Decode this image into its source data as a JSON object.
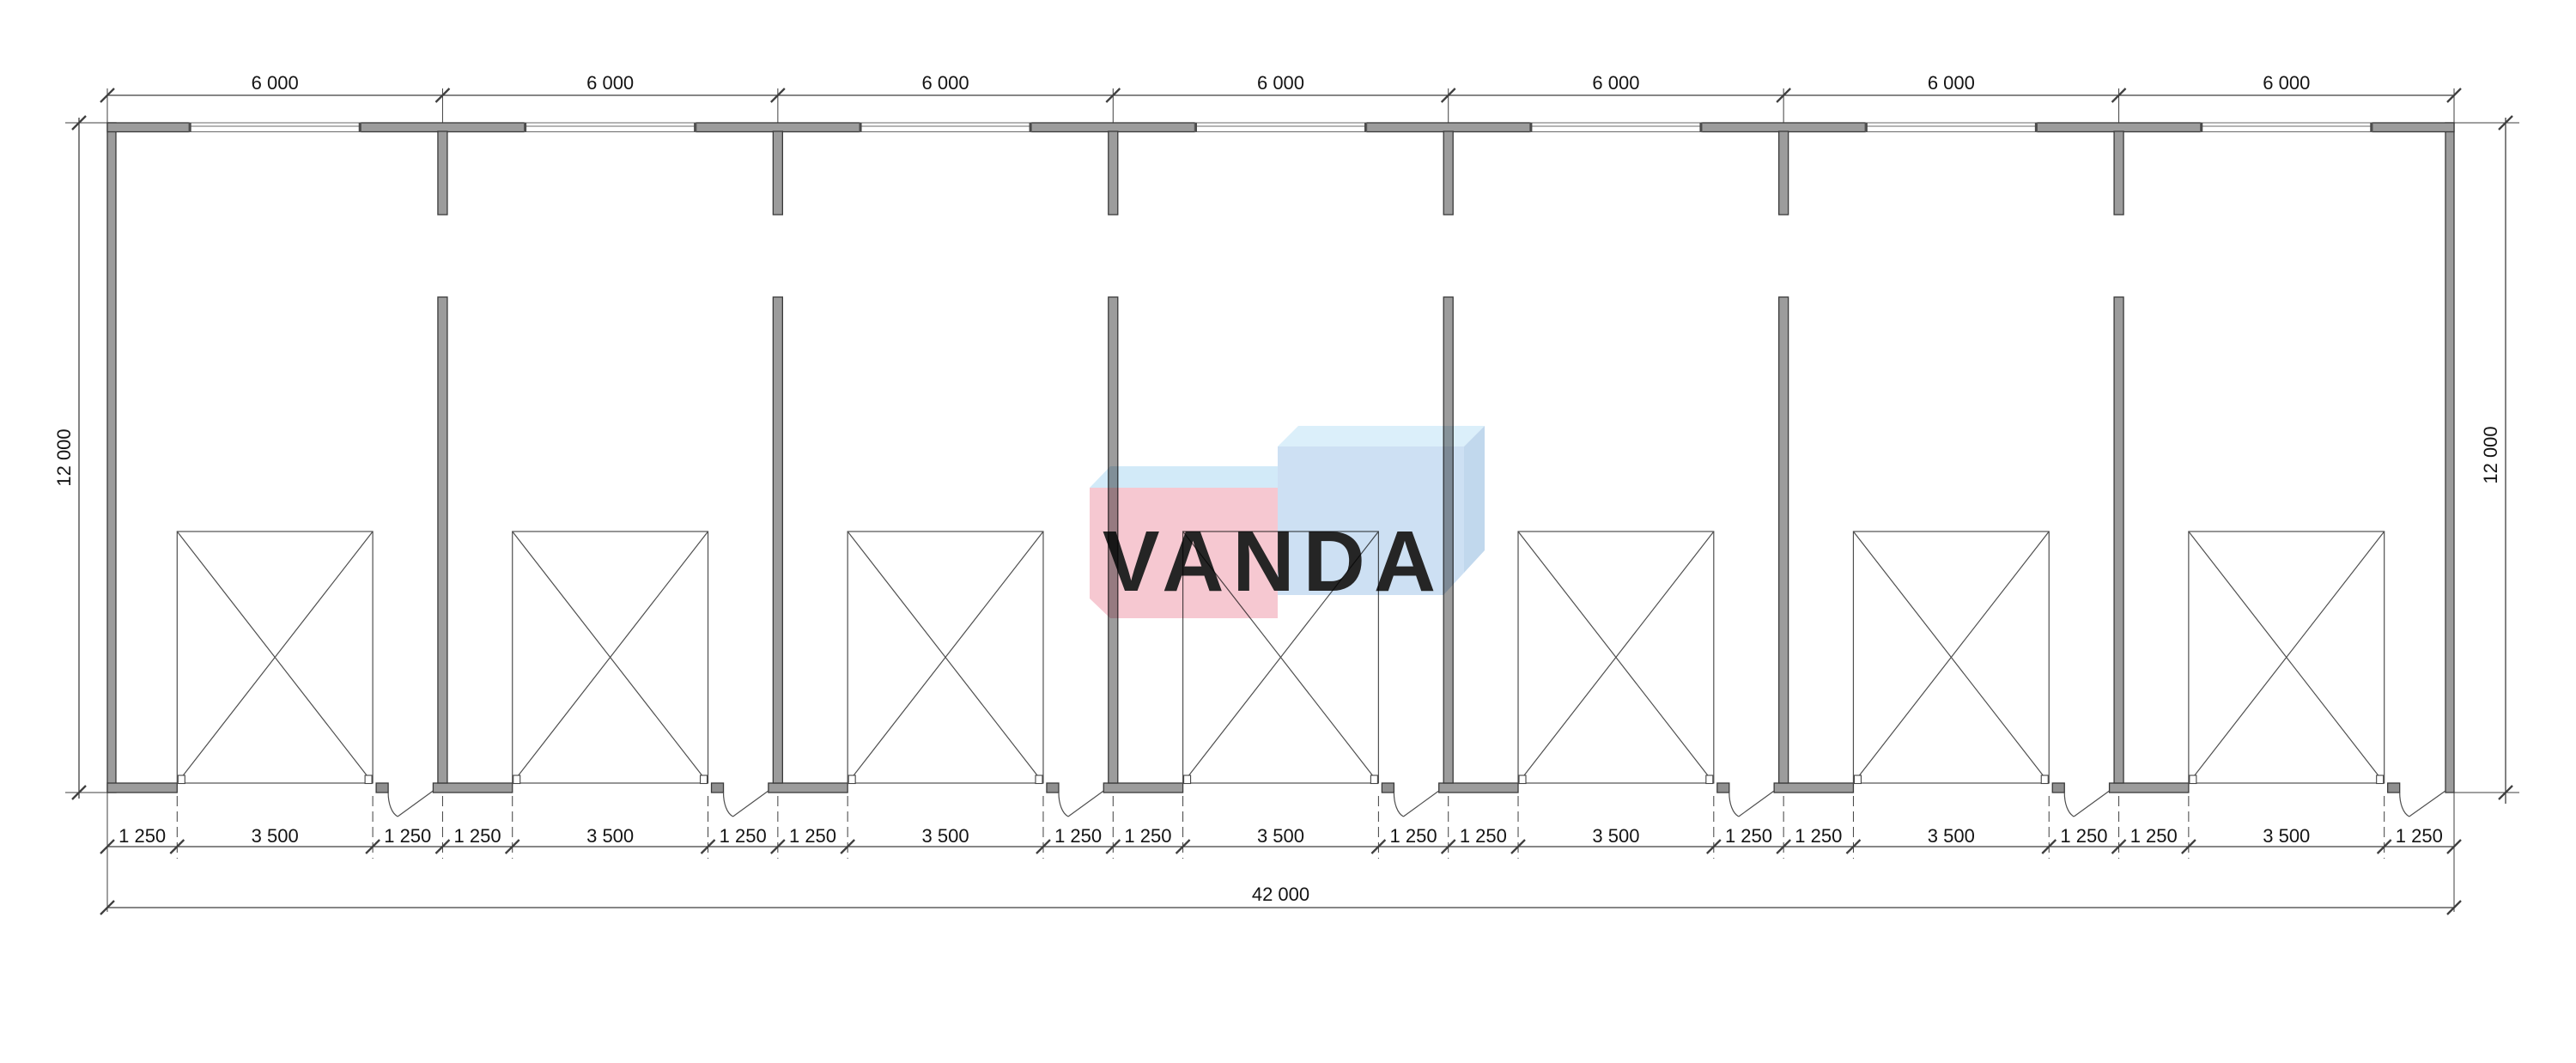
{
  "drawing": {
    "type": "architectural-floor-plan",
    "bay_count": 7
  },
  "dimensions": {
    "top_bay_labels": [
      "6 000",
      "6 000",
      "6 000",
      "6 000",
      "6 000",
      "6 000",
      "6 000"
    ],
    "left_height_label": "12 000",
    "right_height_label": "12 000",
    "bottom_bays": [
      [
        "1 250",
        "3 500",
        "1 250"
      ],
      [
        "1 250",
        "3 500",
        "1 250"
      ],
      [
        "1 250",
        "3 500",
        "1 250"
      ],
      [
        "1 250",
        "3 500",
        "1 250"
      ],
      [
        "1 250",
        "3 500",
        "1 250"
      ],
      [
        "1 250",
        "3 500",
        "1 250"
      ],
      [
        "1 250",
        "3 500",
        "1 250"
      ]
    ],
    "total_width_label": "42 000"
  },
  "watermark": {
    "text": "VANDA",
    "letter_color": "#ffffff",
    "box_left_front": "#f6c4ce",
    "box_left_top": "#cfe9f8",
    "box_right_front": "#c9def2",
    "box_right_top": "#d9eefa",
    "box_right_side": "#bdd5ec"
  },
  "style": {
    "background": "#ffffff",
    "wall_fill": "#9c9c9c",
    "wall_edge": "#3a3a3a",
    "block_fill": "#8f8f8f",
    "thin_line": "#4f4f4f",
    "dim_line": "#3f3f3f",
    "text_color": "#141414"
  }
}
